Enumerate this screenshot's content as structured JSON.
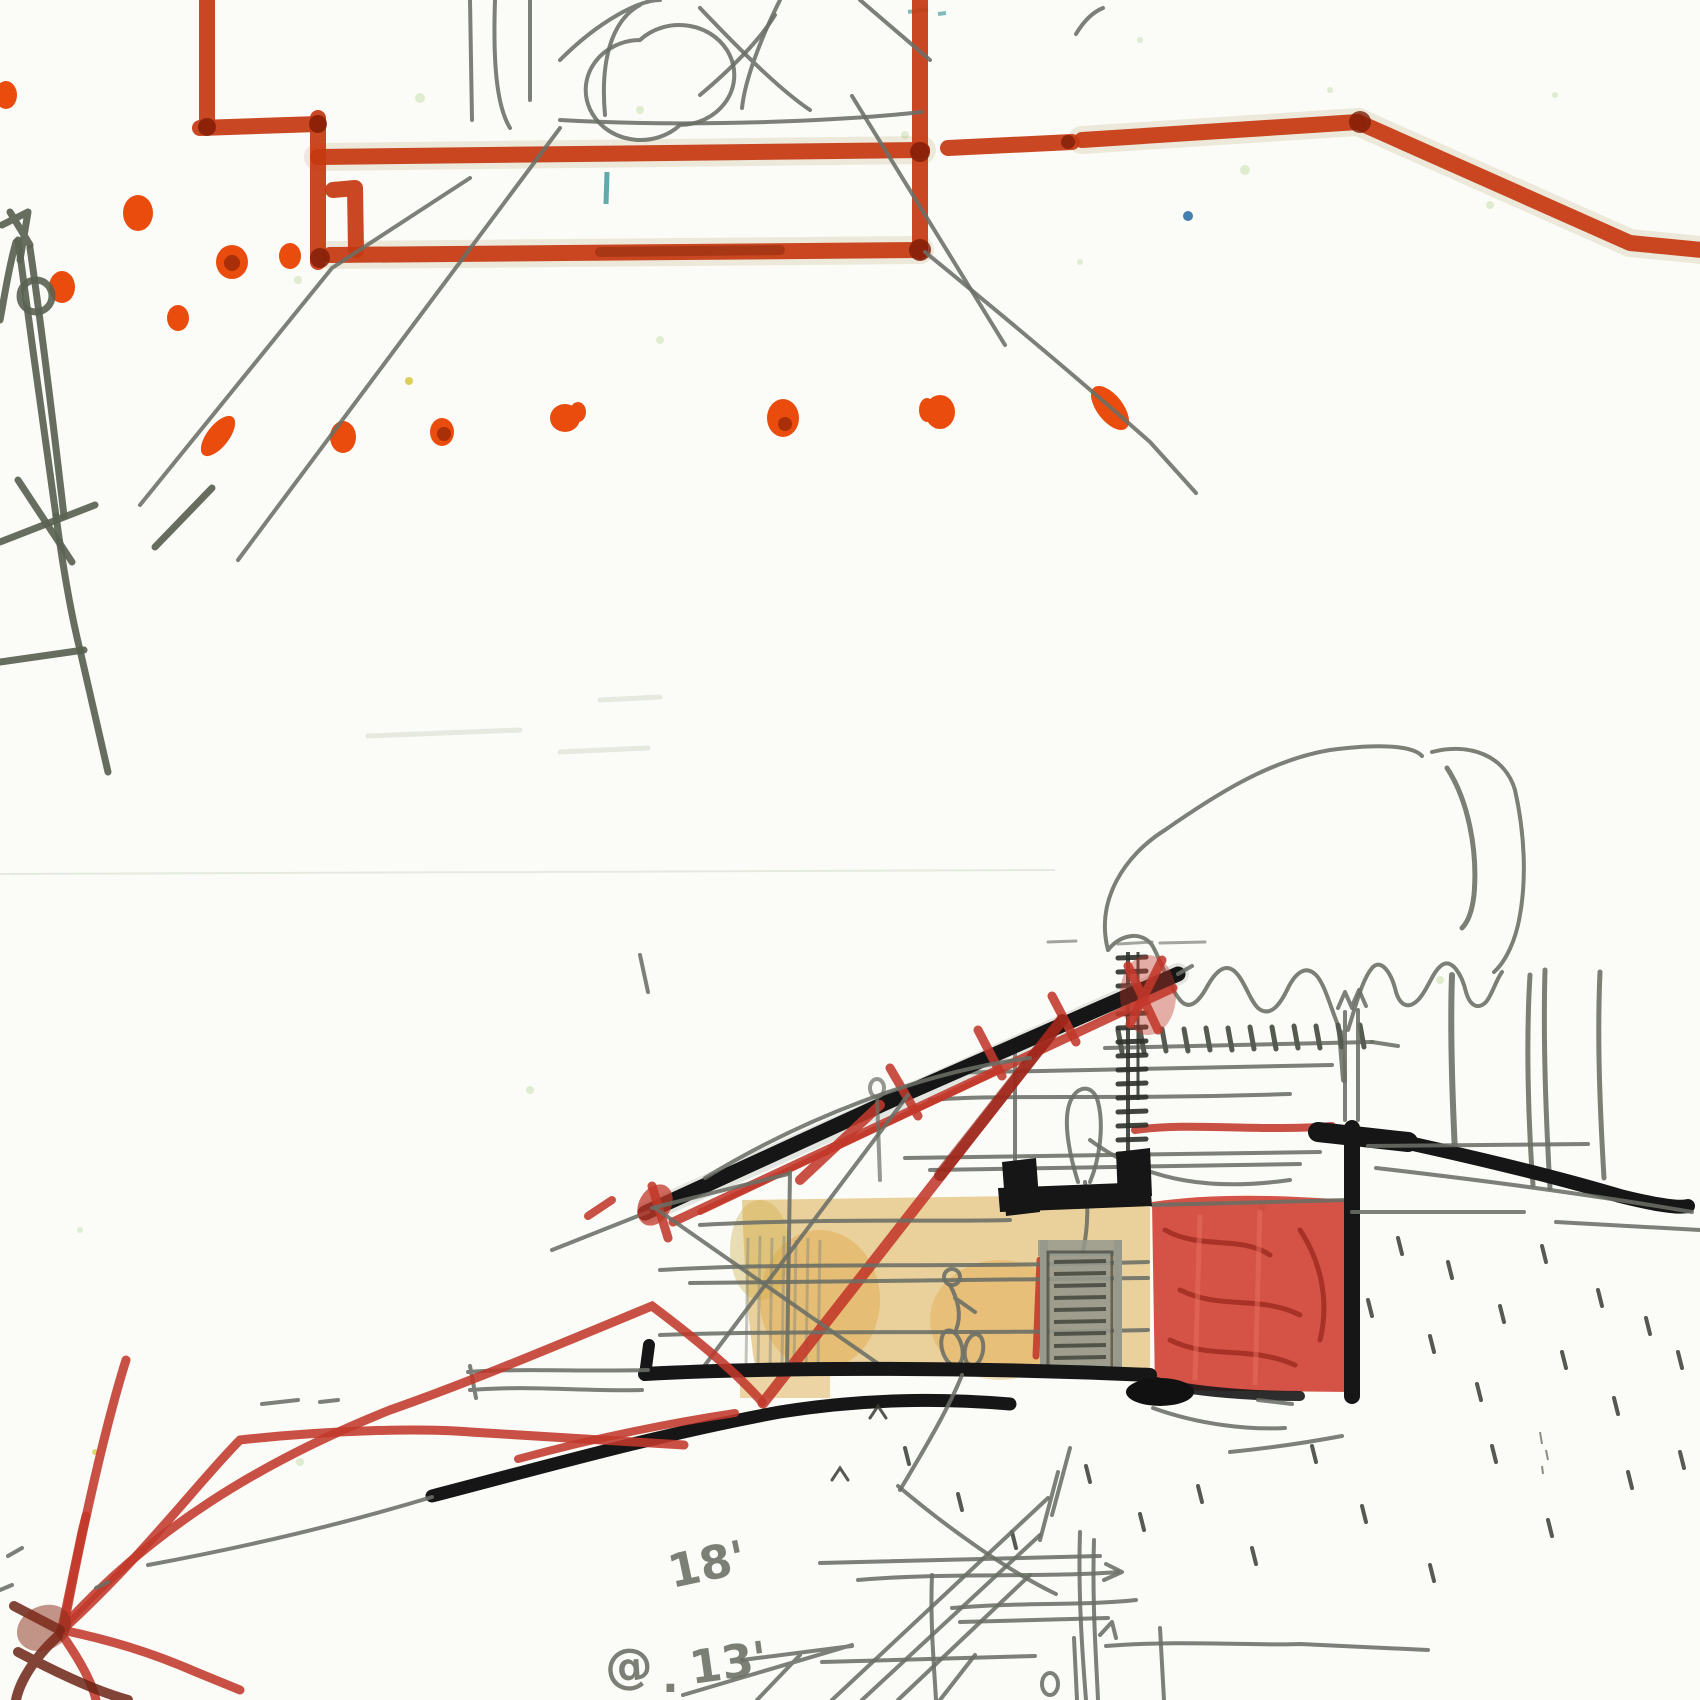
{
  "document": {
    "kind": "hand-drawn architectural concept sketch (scanned)",
    "top_drawing": "partial floor plan in red-orange marker with orange column dots and pencil construction lines",
    "bottom_drawing": "building cross-section with shed roof, red struts, yellow interior, red retaining-wall fill, tree canopy and grade lines"
  },
  "annotations": {
    "dim_18": "18'",
    "at_symbol": "@",
    "period": ".",
    "dim_13": "13'"
  },
  "palette": {
    "paper": "#fbfcf8",
    "red-marker": "#c63912",
    "red-dark": "#7e1d08",
    "orange-dot": "#ea4c0e",
    "crayon-red": "#c2382a",
    "crayon-red-dark": "#8c1d12",
    "ink-black": "#161616",
    "pencil": "#6a6e65",
    "olive": "#5a6252",
    "ochre": "#d9a53e",
    "ochre-deep": "#dd8f1c",
    "door-gray": "#97998d",
    "teal": "#2f8f8f",
    "blue": "#2469a0",
    "speck-green": "#c3dca6"
  }
}
